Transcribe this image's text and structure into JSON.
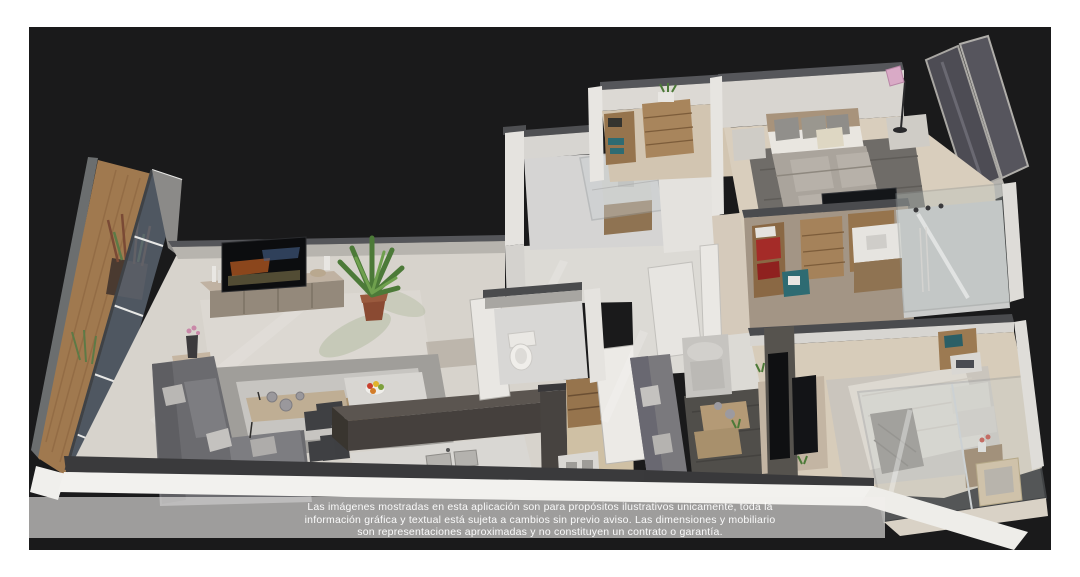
{
  "canvas": {
    "page_background": "#ffffff",
    "viewport_background": "#1b1b1c"
  },
  "scene": {
    "type": "3d-isometric-apartment-cutaway-render",
    "rooms": [
      "balcony",
      "living-room",
      "dining-area",
      "kitchen",
      "walk-in-closet",
      "hallway",
      "bathroom",
      "guest-bathroom",
      "wardrobe-room",
      "master-bedroom",
      "closet-laundry",
      "ensuite-bathroom",
      "family-tv-area",
      "second-bedroom",
      "second-balcony"
    ],
    "palette": {
      "floor": "#d7d3cc",
      "floor_bedroom": "#d9cebd",
      "wall_face": "#e6e4e0",
      "wall_cap": "#55565a",
      "wood": "#a5825a",
      "sofa_dark": "#6b6b6f",
      "sofa_light": "#c6c4c0",
      "glass": "#5d6673",
      "accent_red": "#a42b28",
      "accent_teal": "#2e6b72",
      "plant_green": "#4c7a38",
      "lamp_pink": "#d9aac6"
    }
  },
  "disclaimer": {
    "line1": "Las imágenes mostradas en esta aplicación son para propósitos ilustrativos unicamente, toda la",
    "line2": "información gráfica y textual está sujeta a cambios sin previo aviso. Las dimensiones y mobiliario",
    "line3": "son representaciones aproximadas y no constituyen un contrato o garantía."
  }
}
